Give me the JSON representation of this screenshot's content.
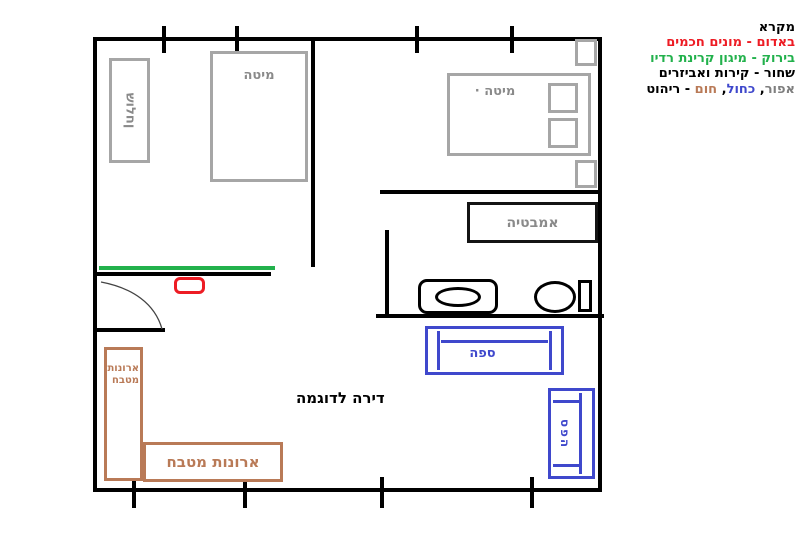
{
  "colors": {
    "red": "#ed1c24",
    "green": "#22b14c",
    "blue": "#3f48cc",
    "brown": "#b97a57",
    "gray": "#7f7f7f",
    "furniture_gray": "#a6a6a6",
    "wall_black": "#000000"
  },
  "legend": {
    "title": "מקרא",
    "items": [
      {
        "text": "באדום - מונים חכמים",
        "color": "#ed1c24"
      },
      {
        "text": "בירוק - מיגון קרינת רדיו",
        "color": "#22b14c"
      },
      {
        "text": "שחור - קירות ואביזרים",
        "color": "#000000"
      }
    ],
    "furniture_parts": [
      {
        "text": "אפור",
        "color": "#7f7f7f"
      },
      {
        "text": ", ",
        "color": "#000000"
      },
      {
        "text": "כחול",
        "color": "#3f48cc"
      },
      {
        "text": ", ",
        "color": "#000000"
      },
      {
        "text": "חום",
        "color": "#b97a57"
      },
      {
        "text": " - ריהוט",
        "color": "#000000"
      }
    ]
  },
  "plan": {
    "title": "דירה לדוגמה",
    "labels": {
      "table": "שולחן",
      "bed1": "מיטה",
      "bed2": "· מיטה",
      "bathtub": "אמבטיה",
      "sofa": "ספה",
      "sofa_vertical": "ספה",
      "kitchen_cabinets_vertical": "ארונות מטבח",
      "kitchen_cabinets_horizontal": "ארונות מטבח"
    }
  }
}
